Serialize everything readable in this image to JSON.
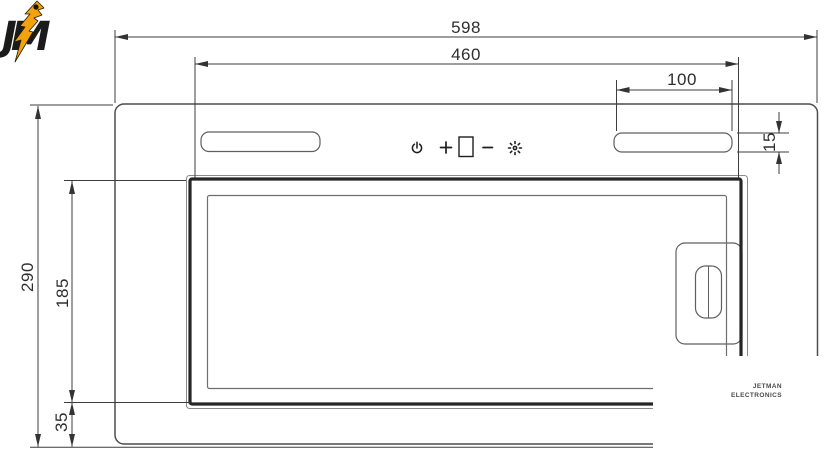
{
  "dimensions": {
    "overall_width": "598",
    "cutout_width": "460",
    "duct_width": "100",
    "duct_height": "15",
    "overall_height": "290",
    "panel_height": "185",
    "bottom_height": "35"
  },
  "control_panel": {
    "icons": [
      "power",
      "plus",
      "display",
      "minus",
      "light"
    ]
  },
  "watermark": {
    "line1": "JETMAN",
    "line2": "ELECTRONICS",
    "monogram": "JM",
    "bolt_color": "#F2A20D",
    "letter_color": "#1B1B1B"
  },
  "colors": {
    "background": "#FFFFFF",
    "outline": "#4D4D4D",
    "panel_heavy": "#262626",
    "dimension": "#3D3D3D"
  }
}
